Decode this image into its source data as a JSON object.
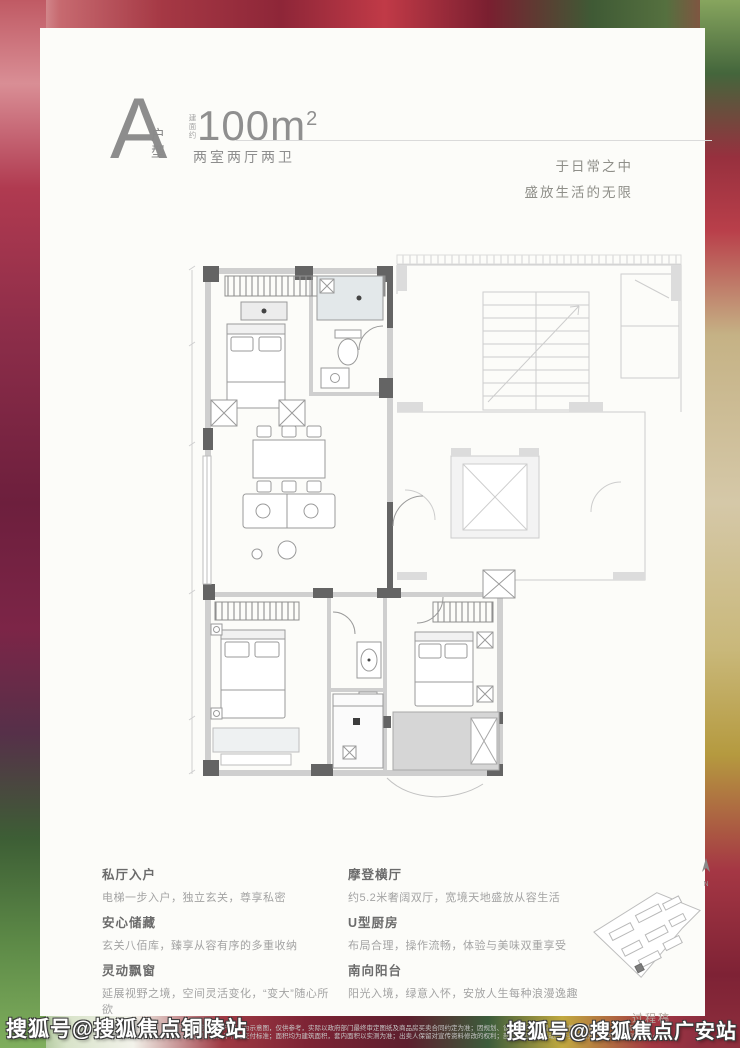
{
  "header": {
    "unit_letter": "A",
    "unit_type_label": "户型",
    "area_prefix": "建面约",
    "area_number": "100",
    "area_unit": "m",
    "area_sup": "2",
    "rooms_label": "两室两厅两卫",
    "tagline_line1": "于日常之中",
    "tagline_line2": "盛放生活的无限"
  },
  "features": {
    "left": [
      {
        "title": "私厅入户",
        "desc": "电梯一步入户，独立玄关，尊享私密"
      },
      {
        "title": "安心储藏",
        "desc": "玄关八佰库，臻享从容有序的多重收纳"
      },
      {
        "title": "灵动飘窗",
        "desc": "延展视野之境，空间灵活变化，“变大”随心所欲"
      }
    ],
    "right": [
      {
        "title": "摩登横厅",
        "desc": "约5.2米奢阔双厅，宽境天地盛放从容生活"
      },
      {
        "title": "U型厨房",
        "desc": "布局合理，操作流畅，体验与美味双重享受"
      },
      {
        "title": "南向阳台",
        "desc": "阳光入境，绿意入怀，安放人生每种浪漫逸趣"
      }
    ]
  },
  "compass": {
    "label": "N"
  },
  "footer": {
    "draft_label": "过程稿",
    "disclaimer_line1": "本资料仅为要约邀请，不构成要约或承诺；户型图为示意图，仅供参考，实际以政府部门最终审定图纸及商品房买卖合同约定为准；因规划、设计变更等原因，实际情况可能变化，敬请留意。",
    "disclaimer_line2": "本资料中装修、家具及陈设仅为效果示意，不作为交付标准；面积均为建筑面积，套内面积以实测为准；出卖人保留对宣传资料修改的权利；部分信息如有变动恕不另行通知，详情请垂询销售中心。"
  },
  "watermarks": {
    "bottom_left": "搜狐号@搜狐焦点铜陵站",
    "bottom_right": "搜狐号@搜狐焦点广安站"
  },
  "colors": {
    "card_bg": "#fcfcf9",
    "text_gray": "#8d8d8d",
    "wall_dark": "#646464",
    "wall_light": "#cfcfcf",
    "ghost_gray": "#cccccc",
    "wet_area": "#e3e8ea",
    "balcony_fill": "#d6d6d6",
    "watermark_text": "#ffffff"
  }
}
